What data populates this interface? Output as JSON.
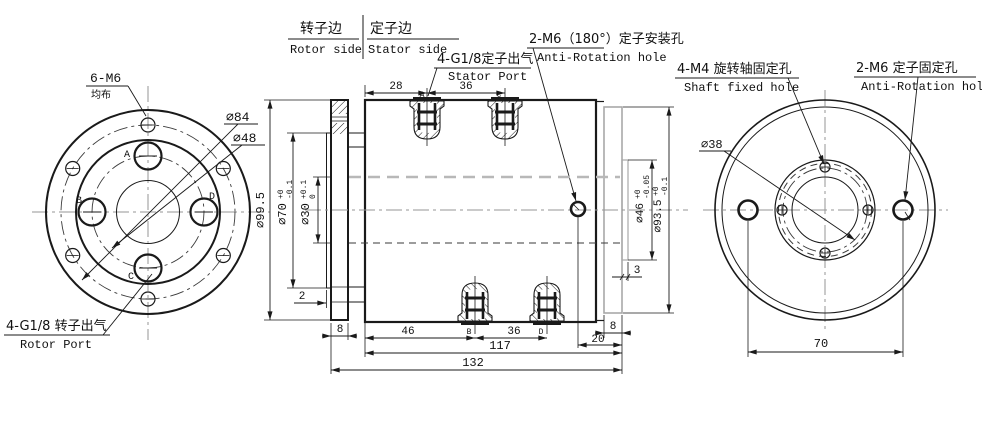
{
  "title": "Pneumatic rotary joint engineering drawing",
  "hd": {
    "rc": "转子边",
    "re": "Rotor side",
    "sc": "定子边",
    "se": "Stator side"
  },
  "lv": {
    "m6": "6-M6",
    "m6note": "均布",
    "d84": "⌀84",
    "d48": "⌀48",
    "rp_cn": "4-G1/8 转子出气",
    "rp_en": "Rotor Port",
    "pa": "A",
    "pb": "B",
    "pc": "C",
    "pd": "D"
  },
  "sv": {
    "sp_cn": "4-G1/8定子出气",
    "sp_en": "Stator Port",
    "sm_cn": "2-M6（180°）定子安装孔",
    "sm_en": "Anti-Rotation hole",
    "pa": "A",
    "pb": "B",
    "pc": "C",
    "pd": "D",
    "d28": "28",
    "d36t": "36",
    "d995": "⌀99.5",
    "d70": "⌀70",
    "d70u": "+0",
    "d70d": "-0.1",
    "d30": "⌀30",
    "d30u": "+0.1",
    "d30d": "0",
    "d2": "2",
    "d8l": "8",
    "d46b": "46",
    "d36b": "36",
    "d8r": "8",
    "d20": "20",
    "d117": "117",
    "d132": "132",
    "d3": "3",
    "d46": "⌀46",
    "d46u": "+0",
    "d46d": "-0.05",
    "d935": "⌀93.5",
    "d935u": "+0",
    "d935d": "-0.1"
  },
  "rv": {
    "sf_cn": "4-M4 旋转轴固定孔",
    "sf_en": "Shaft fixed hole",
    "af_cn": "2-M6 定子固定孔",
    "af_en": "Anti-Rotation hole",
    "d38": "⌀38",
    "d70": "70"
  },
  "colors": {
    "line": "#1a1a1a",
    "centerline": "#969696",
    "stator_outline": "#a8a8a8",
    "background": "#ffffff"
  }
}
